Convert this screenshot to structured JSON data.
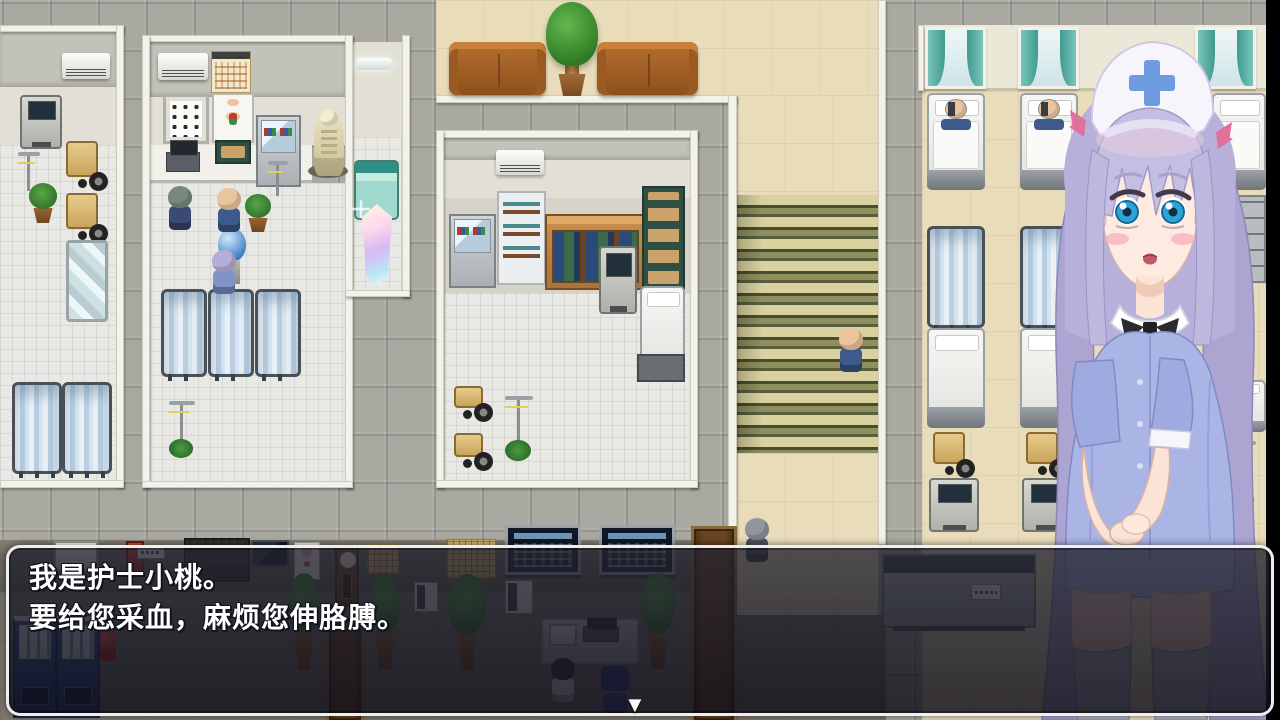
{
  "window_type": "rpg-dialogue-scene",
  "scene": "hospital-interior-map",
  "dialogue": {
    "speaker": "nurse-portrait",
    "line1": "我是护士小桃。",
    "line2": "要给您采血，麻烦您伸胳膊。",
    "continue_indicator": "▼"
  },
  "colors": {
    "dialog_border": "#fafafa",
    "dialog_background": "rgba(24,24,34,0.8)",
    "nurse_uniform_blue": "#aab5e6",
    "nurse_hair_lavender": "#b6b0da",
    "nurse_eye_blue": "#2ba4da",
    "nurse_ribbon_pink": "#e0719c",
    "stairs_olive": "#8f8f5e",
    "floor_beige": "#e9dcba",
    "corridor_tile_gray": "#a9a9a1",
    "ward_curtain_teal": "#5fb8ac",
    "privacy_screen_blue": "#b9cfe0",
    "sofa_brown": "#a8622e",
    "vending_machine_blue": "#2d4f9c"
  }
}
